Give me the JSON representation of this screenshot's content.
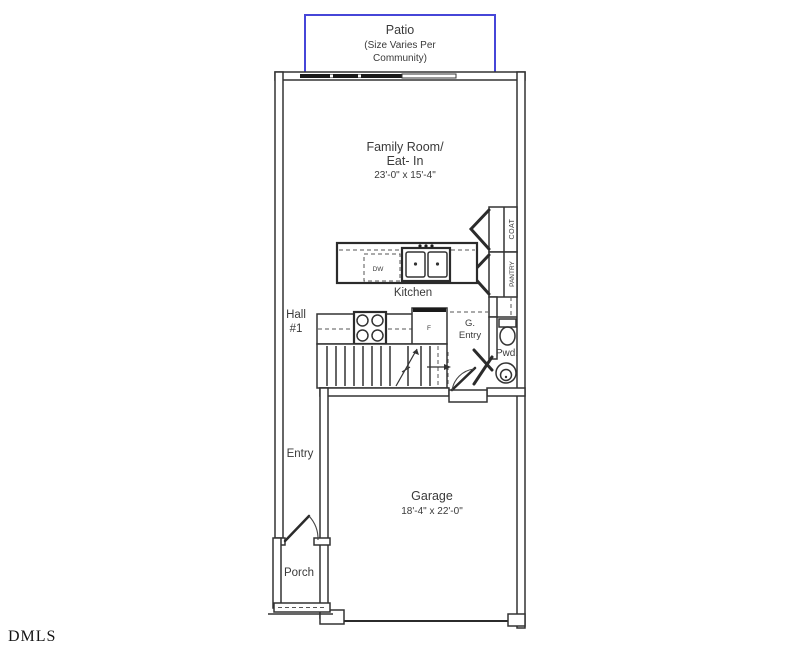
{
  "watermark": "DMLS",
  "colors": {
    "wall": "#333333",
    "patio_border": "#4646d8",
    "text": "#3a3a3a"
  },
  "rooms": {
    "patio": {
      "name": "Patio",
      "note_line1": "(Size Varies Per",
      "note_line2": "Community)"
    },
    "family_room": {
      "name_line1": "Family Room/",
      "name_line2": "Eat- In",
      "dimensions": "23'-0\" x 15'-4\""
    },
    "kitchen": {
      "name": "Kitchen"
    },
    "hall": {
      "name_line1": "Hall",
      "name_line2": "#1"
    },
    "coat": {
      "name": "COAT"
    },
    "pantry": {
      "name": "PANTRY"
    },
    "g_entry": {
      "name_line1": "G.",
      "name_line2": "Entry"
    },
    "pwd": {
      "name": "Pwd."
    },
    "entry": {
      "name": "Entry"
    },
    "porch": {
      "name": "Porch"
    },
    "garage": {
      "name": "Garage",
      "dimensions": "18'-4\" x 22'-0\""
    }
  },
  "appliances": {
    "dishwasher": "DW",
    "refrigerator": "F"
  }
}
